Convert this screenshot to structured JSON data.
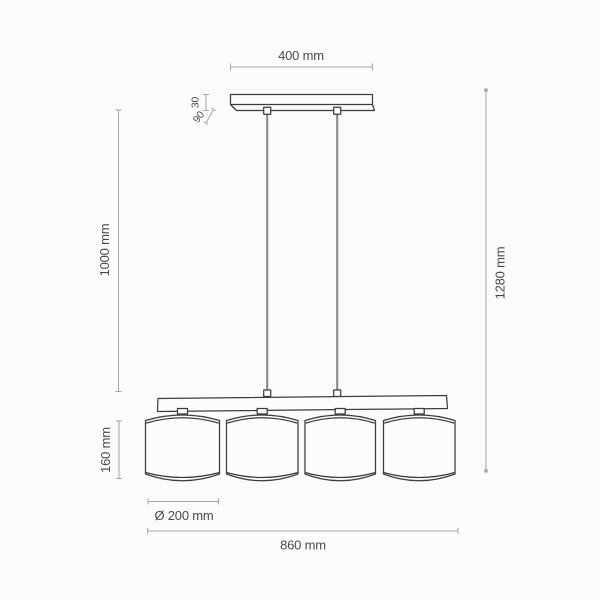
{
  "colors": {
    "outline": "#3d3d40",
    "dimension": "#a6a6a6",
    "label": "#4a4a4a",
    "cable": "#8e8e8e",
    "background": "#fbfbfa"
  },
  "drawing": {
    "name": "four-shade pendant lamp dimensional drawing",
    "labels": {
      "canopy_width": "400 mm",
      "canopy_thickness": "30",
      "canopy_depth": "90",
      "suspension_length": "1000 mm",
      "overall_height": "1280 mm",
      "shade_height": "160 mm",
      "shade_diameter": "Ø 200 mm",
      "overall_width": "860 mm"
    }
  }
}
